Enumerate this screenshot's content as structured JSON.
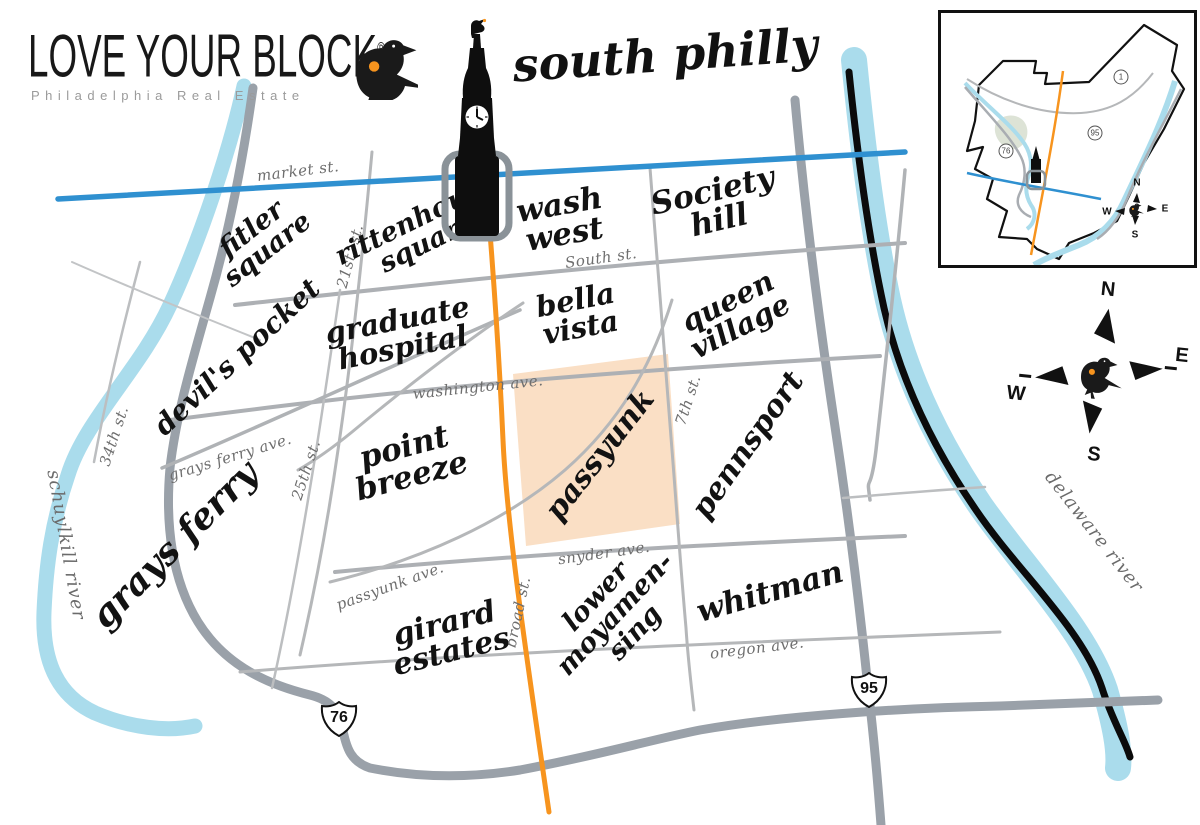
{
  "brand": {
    "name": "LOVE YOUR BLOCK",
    "reg": "®",
    "tagline": "Philadelphia Real Estate"
  },
  "title": "south philly",
  "neighborhoods": [
    {
      "id": "fitler-square",
      "lines": [
        "fitler",
        "square"
      ]
    },
    {
      "id": "rittenhouse-square",
      "lines": [
        "rittenhouse",
        "square"
      ]
    },
    {
      "id": "wash-west",
      "lines": [
        "wash",
        "west"
      ]
    },
    {
      "id": "society-hill",
      "lines": [
        "Society",
        "hill"
      ]
    },
    {
      "id": "devils-pocket",
      "lines": [
        "devil's pocket"
      ]
    },
    {
      "id": "graduate-hospital",
      "lines": [
        "graduate",
        "hospital"
      ]
    },
    {
      "id": "bella-vista",
      "lines": [
        "bella",
        "vista"
      ]
    },
    {
      "id": "queen-village",
      "lines": [
        "queen",
        "village"
      ]
    },
    {
      "id": "grays-ferry",
      "lines": [
        "grays ferry"
      ]
    },
    {
      "id": "point-breeze",
      "lines": [
        "point",
        "breeze"
      ]
    },
    {
      "id": "passyunk",
      "lines": [
        "passyunk"
      ]
    },
    {
      "id": "pennsport",
      "lines": [
        "pennsport"
      ]
    },
    {
      "id": "girard-estates",
      "lines": [
        "girard",
        "estates"
      ]
    },
    {
      "id": "lower-moyamensing",
      "lines": [
        "lower",
        "moyamen-",
        "sing"
      ]
    },
    {
      "id": "whitman",
      "lines": [
        "whitman"
      ]
    }
  ],
  "streets": [
    {
      "id": "market-st",
      "label": "market st."
    },
    {
      "id": "south-st",
      "label": "South st."
    },
    {
      "id": "washington-ave",
      "label": "washington ave."
    },
    {
      "id": "snyder-ave",
      "label": "snyder ave."
    },
    {
      "id": "oregon-ave",
      "label": "oregon ave."
    },
    {
      "id": "grays-ferry-ave",
      "label": "grays ferry ave."
    },
    {
      "id": "passyunk-ave",
      "label": "passyunk ave."
    },
    {
      "id": "broad-st",
      "label": "broad st."
    },
    {
      "id": "21st-st",
      "label": "21st. st."
    },
    {
      "id": "25th-st",
      "label": "25th st."
    },
    {
      "id": "7th-st",
      "label": "7th st."
    },
    {
      "id": "34th-st",
      "label": "34th st."
    }
  ],
  "rivers": [
    {
      "id": "schuylkill",
      "label": "schuylkill river"
    },
    {
      "id": "delaware",
      "label": "delaware river"
    }
  ],
  "highway_shields": [
    {
      "id": "i76",
      "number": "76"
    },
    {
      "id": "i95",
      "number": "95"
    }
  ],
  "compass": {
    "north": "N",
    "east": "E",
    "south": "S",
    "west": "W"
  },
  "inset": {
    "route_markers": [
      "1",
      "95",
      "76"
    ],
    "compass": {
      "north": "N",
      "east": "E",
      "south": "S",
      "west": "W"
    }
  },
  "highlight": {
    "neighborhood": "passyunk",
    "color": "#fadfc5"
  },
  "colors": {
    "market_st_blue": "#2f90d0",
    "broad_st_orange": "#f7941e",
    "river_blue": "#aadcec",
    "highway_gray": "#9aa1a9",
    "road_gray": "#adb0b4",
    "street_label_gray": "#6e6e6e",
    "ink": "#111111",
    "heart_orange": "#f7941e"
  }
}
